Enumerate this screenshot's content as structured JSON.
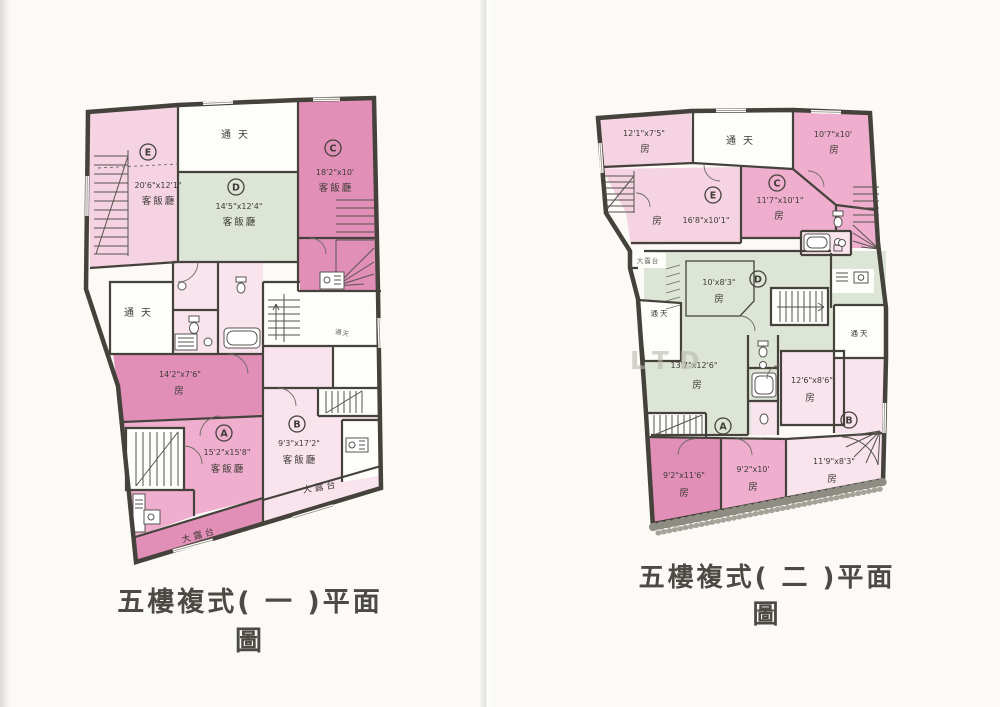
{
  "page": {
    "background": "#fbfaf6",
    "watermark": "LTD",
    "colors": {
      "wall": "#45423c",
      "pink_dark": "#e28fb8",
      "pink_medium": "#efaecd",
      "pink_light": "#f5d3e2",
      "pink_pale": "#f9e4ee",
      "green": "#dde5d7",
      "room_white": "#fdfdfa",
      "ink": "#3e3b36",
      "title": "#4c4a44"
    }
  },
  "plan1": {
    "title": "五樓複式( 一 )平面圖",
    "sky_top": "通天",
    "sky_left": "通天",
    "sky_small": "通天",
    "terrace_a": "大露台",
    "terrace_b": "大露台",
    "units": {
      "A": {
        "letter": "A",
        "dim": "15'2\"x15'8\"",
        "room": "客飯廳"
      },
      "B": {
        "letter": "B",
        "dim": "9'3\"x17'2\"",
        "room": "客飯廳"
      },
      "C": {
        "letter": "C",
        "dim": "18'2\"x10'",
        "room": "客飯廳"
      },
      "D": {
        "letter": "D",
        "dim": "14'5\"x12'4\"",
        "room": "客飯廳"
      },
      "E": {
        "letter": "E",
        "dim": "20'6\"x12'1\"",
        "room": "客飯廳"
      },
      "bedroom": {
        "dim": "14'2\"x7'6\"",
        "room": "房"
      }
    }
  },
  "plan2": {
    "title": "五樓複式( 二 )平面圖",
    "sky_top": "通天",
    "sky_left": "通天",
    "sky_right": "通天",
    "terrace": "大露台",
    "units": {
      "A": {
        "letter": "A"
      },
      "B": {
        "letter": "B"
      },
      "C": {
        "letter": "C",
        "dim": "11'7\"x10'1\"",
        "room": "房"
      },
      "D": {
        "letter": "D"
      },
      "E": {
        "letter": "E",
        "dim": "16'8\"x10'1\"",
        "room": "房"
      }
    },
    "rooms": {
      "top_left": {
        "dim": "12'1\"x7'5\"",
        "room": "房"
      },
      "top_right": {
        "dim": "10'7\"x10'",
        "room": "房"
      },
      "d_small": {
        "dim": "10'x8'3\"",
        "room": "房"
      },
      "mid_left": {
        "dim": "13'7\"x12'6\"",
        "room": "房"
      },
      "mid_right": {
        "dim": "12'6\"x8'6\"",
        "room": "房"
      },
      "bottom_left": {
        "dim": "9'2\"x11'6\"",
        "room": "房"
      },
      "bottom_mid": {
        "dim": "9'2\"x10'",
        "room": "房"
      },
      "bottom_right": {
        "dim": "11'9\"x8'3\"",
        "room": "房"
      }
    }
  }
}
